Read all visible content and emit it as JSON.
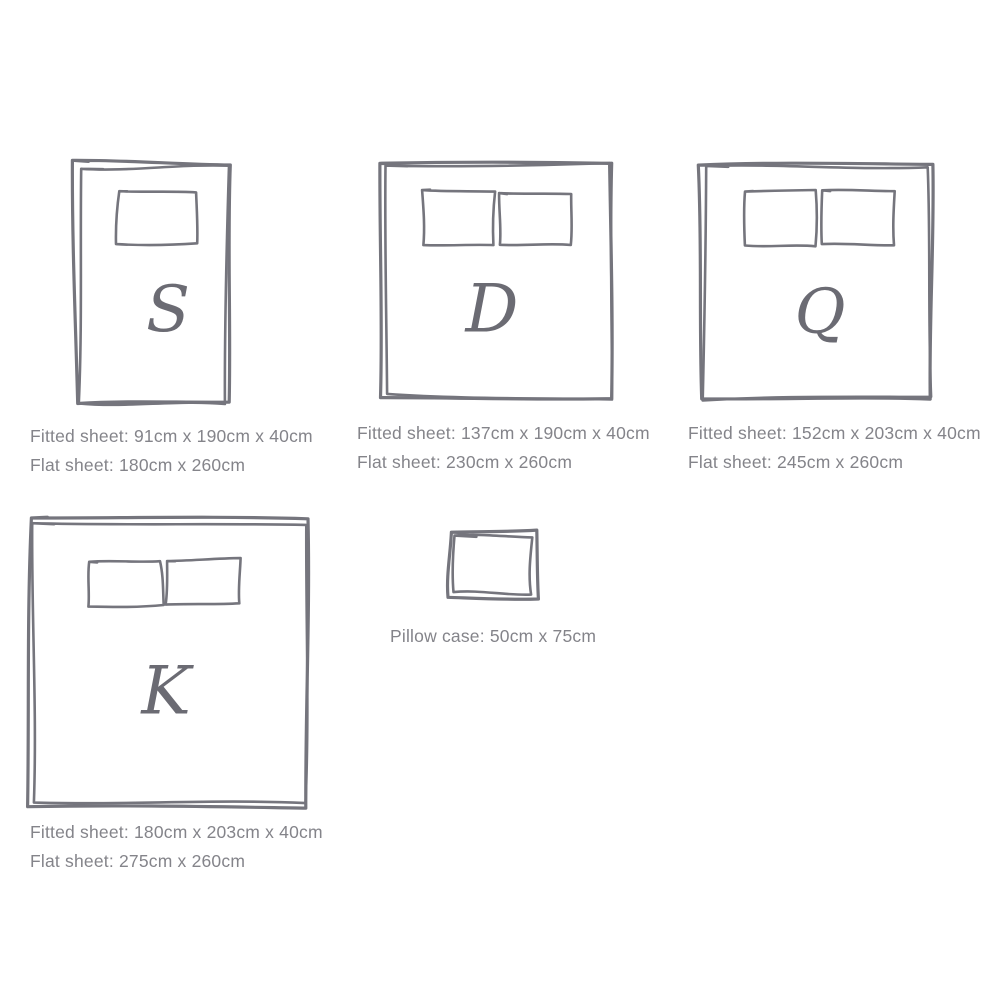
{
  "style": {
    "stroke_color": "#75757d",
    "text_color": "#84848a",
    "letter_color": "#6b6b73",
    "background": "#ffffff"
  },
  "sizes": [
    {
      "id": "single",
      "letter": "S",
      "fitted": "Fitted sheet: 91cm x 190cm x 40cm",
      "flat": "Flat sheet: 180cm x 260cm"
    },
    {
      "id": "double",
      "letter": "D",
      "fitted": "Fitted sheet: 137cm x 190cm x 40cm",
      "flat": "Flat sheet: 230cm x 260cm"
    },
    {
      "id": "queen",
      "letter": "Q",
      "fitted": "Fitted sheet: 152cm x 203cm x 40cm",
      "flat": "Flat sheet: 245cm x 260cm"
    },
    {
      "id": "king",
      "letter": "K",
      "fitted": "Fitted sheet: 180cm x 203cm x 40cm",
      "flat": "Flat sheet: 275cm x 260cm"
    }
  ],
  "pillow": {
    "label": "Pillow case: 50cm x 75cm"
  }
}
